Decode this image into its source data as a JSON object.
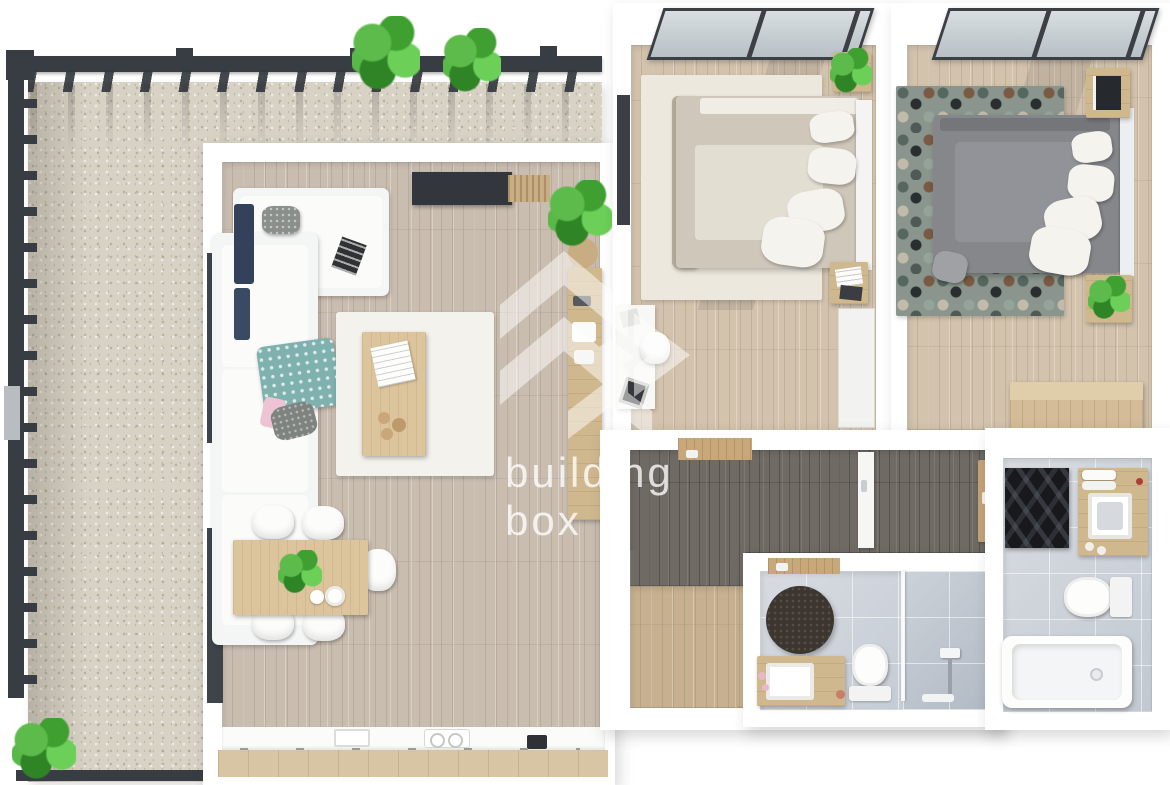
{
  "scene": {
    "type": "3d-floorplan-top-view",
    "rooms": [
      "terrace",
      "living-room-kitchen",
      "bedroom-1",
      "bedroom-2",
      "hallway",
      "bathroom-1",
      "bathroom-2"
    ]
  },
  "watermark": {
    "logo_icon": "chevron-box-logo",
    "line1": "building",
    "line2": "box"
  },
  "palette": {
    "background": "#ffffff",
    "gravel": "#d8d2c5",
    "pergola_dark": "#383d43",
    "wood_floor_living": "#c9bdb0",
    "wood_floor_bedroom": "#d3c3ad",
    "wood_floor_hall": "#6f6a64",
    "wood_floor_entry": "#c7b08f",
    "kitchen_cabinet_wood": "#d8c5a3",
    "furniture_wood": "#d0b88e",
    "bathroom_tile": "#c7cdd5",
    "sofa_white": "#f4f5f5",
    "bed_beige": "#cfc7ba",
    "bed_gray": "#85878b",
    "rug_cream": "#efece3",
    "rug_hex_teal": "#5d736e",
    "rug_hex_brown": "#74523c",
    "rug_black": "#17191d",
    "plant_green": "#4fae3f",
    "accent_navy": "#33415a",
    "accent_teal": "#7fb1ae",
    "watermark_white": "rgba(255,255,255,0.78)"
  }
}
